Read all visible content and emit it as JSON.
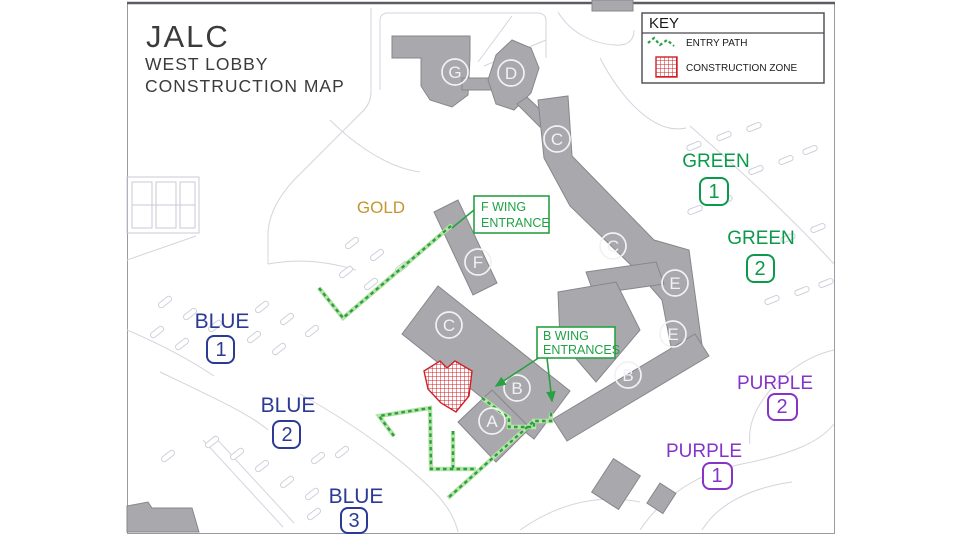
{
  "map_title": {
    "line1": "JALC",
    "line2": "WEST LOBBY",
    "line3": "CONSTRUCTION MAP"
  },
  "legend": {
    "title": "KEY",
    "items": [
      {
        "label": "ENTRY PATH",
        "symbol": "green-dashed-path",
        "color": "#28a043"
      },
      {
        "label": "CONSTRUCTION ZONE",
        "symbol": "red-hatched-square",
        "color": "#d02028"
      }
    ]
  },
  "entrance_callouts": [
    {
      "line1": "F WING",
      "line2": "ENTRANCE"
    },
    {
      "line1": "B WING",
      "line2": "ENTRANCES"
    }
  ],
  "buildings": [
    "G",
    "D",
    "C",
    "C",
    "F",
    "C",
    "E",
    "E",
    "B",
    "B",
    "A"
  ],
  "parking": [
    {
      "name": "GOLD",
      "number": null,
      "color": "#c3972f"
    },
    {
      "name": "GREEN",
      "number": "1",
      "color": "#0b9a4b"
    },
    {
      "name": "GREEN",
      "number": "2",
      "color": "#0b9a4b"
    },
    {
      "name": "BLUE",
      "number": "1",
      "color": "#2b3a94"
    },
    {
      "name": "BLUE",
      "number": "2",
      "color": "#2b3a94"
    },
    {
      "name": "BLUE",
      "number": "3",
      "color": "#2b3a94"
    },
    {
      "name": "PURPLE",
      "number": "1",
      "color": "#8633c7"
    },
    {
      "name": "PURPLE",
      "number": "2",
      "color": "#8633c7"
    }
  ],
  "map_colors": {
    "building_fill": "#a9a9ad",
    "building_stroke": "#87878b",
    "entry_path_green": "#28a043",
    "construction_red": "#d02028",
    "road_line": "#d4d4de"
  }
}
